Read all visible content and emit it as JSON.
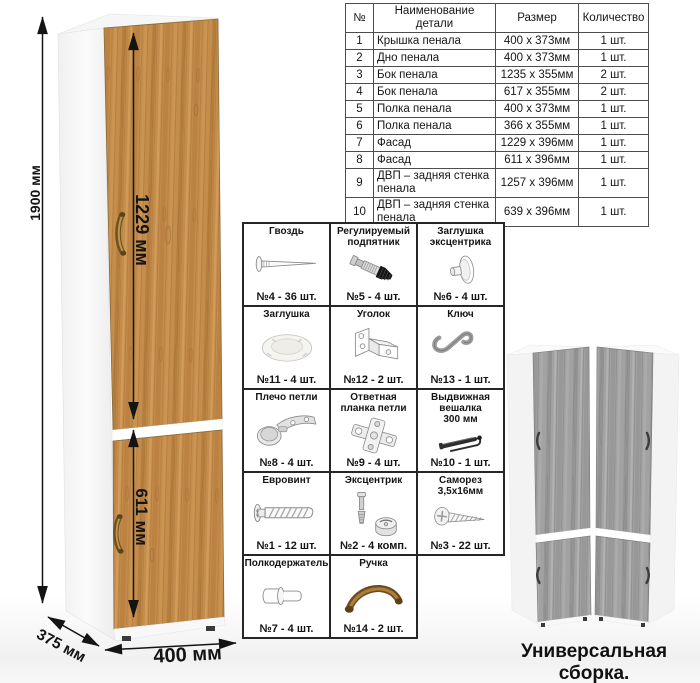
{
  "cabinet": {
    "height_label": "1900 мм",
    "top_door_label": "1229 мм",
    "bottom_door_label": "611 мм",
    "width_label": "400 мм",
    "depth_label": "375 мм"
  },
  "parts_table": {
    "headers": {
      "num": "№",
      "name": "Наименование детали",
      "size": "Размер",
      "qty": "Количество"
    },
    "rows": [
      {
        "num": "1",
        "name": "Крышка пенала",
        "size": "400 х 373мм",
        "qty": "1 шт."
      },
      {
        "num": "2",
        "name": "Дно пенала",
        "size": "400 х 373мм",
        "qty": "1 шт."
      },
      {
        "num": "3",
        "name": "Бок пенала",
        "size": "1235 х 355мм",
        "qty": "2 шт."
      },
      {
        "num": "4",
        "name": "Бок пенала",
        "size": "617 х 355мм",
        "qty": "2 шт."
      },
      {
        "num": "5",
        "name": "Полка пенала",
        "size": "400 х 373мм",
        "qty": "1 шт."
      },
      {
        "num": "6",
        "name": "Полка пенала",
        "size": "366 х 355мм",
        "qty": "1 шт."
      },
      {
        "num": "7",
        "name": "Фасад",
        "size": "1229 х 396мм",
        "qty": "1 шт."
      },
      {
        "num": "8",
        "name": "Фасад",
        "size": "611 х 396мм",
        "qty": "1 шт."
      },
      {
        "num": "9",
        "name": "ДВП – задняя стенка пенала",
        "size": "1257 х 396мм",
        "qty": "1 шт."
      },
      {
        "num": "10",
        "name": "ДВП – задняя стенка пенала",
        "size": "639 х 396мм",
        "qty": "1 шт."
      }
    ]
  },
  "hardware": {
    "items": [
      {
        "title": "Гвоздь",
        "count": "№4 - 36 шт.",
        "icon": "nail-icon"
      },
      {
        "title": "Регулируемый подпятник",
        "count": "№5 - 4 шт.",
        "icon": "adjustable-foot-icon"
      },
      {
        "title": "Заглушка эксцентрика",
        "count": "№6 - 4 шт.",
        "icon": "cam-cap-icon"
      },
      {
        "title": "Заглушка",
        "count": "№11 - 4 шт.",
        "icon": "plug-cap-icon"
      },
      {
        "title": "Уголок",
        "count": "№12 - 2 шт.",
        "icon": "corner-bracket-icon"
      },
      {
        "title": "Ключ",
        "count": "№13 - 1 шт.",
        "icon": "hex-key-icon"
      },
      {
        "title": "Плечо петли",
        "count": "№8 - 4 шт.",
        "icon": "hinge-arm-icon"
      },
      {
        "title": "Ответная планка петли",
        "count": "№9 - 4 шт.",
        "icon": "hinge-plate-icon"
      },
      {
        "title": "Выдвижная\nвешалка\n300 мм",
        "count": "№10 - 1 шт.",
        "icon": "pullout-hanger-icon"
      },
      {
        "title": "Евровинт",
        "count": "№1 - 12 шт.",
        "icon": "euro-screw-icon"
      },
      {
        "title": "Эксцентрик",
        "count": "№2 - 4 комп.",
        "icon": "eccentric-cam-icon"
      },
      {
        "title": "Саморез\n3,5х16мм",
        "count": "№3 - 22 шт.",
        "icon": "self-tapping-screw-icon"
      },
      {
        "title": "Полкодержатель",
        "count": "№7 - 4 шт.",
        "icon": "shelf-pin-icon"
      },
      {
        "title": "Ручка",
        "count": "№14 - 2 шт.",
        "icon": "handle-icon"
      }
    ]
  },
  "footer": {
    "caption": "Универсальная сборка."
  },
  "colors": {
    "oak_wood": "#c58d4c",
    "gray_wood": "#a2a2a2",
    "handle_bronze": "#6f5120",
    "dimension_ink": "#141414",
    "table_border": "#4d4d4d"
  }
}
